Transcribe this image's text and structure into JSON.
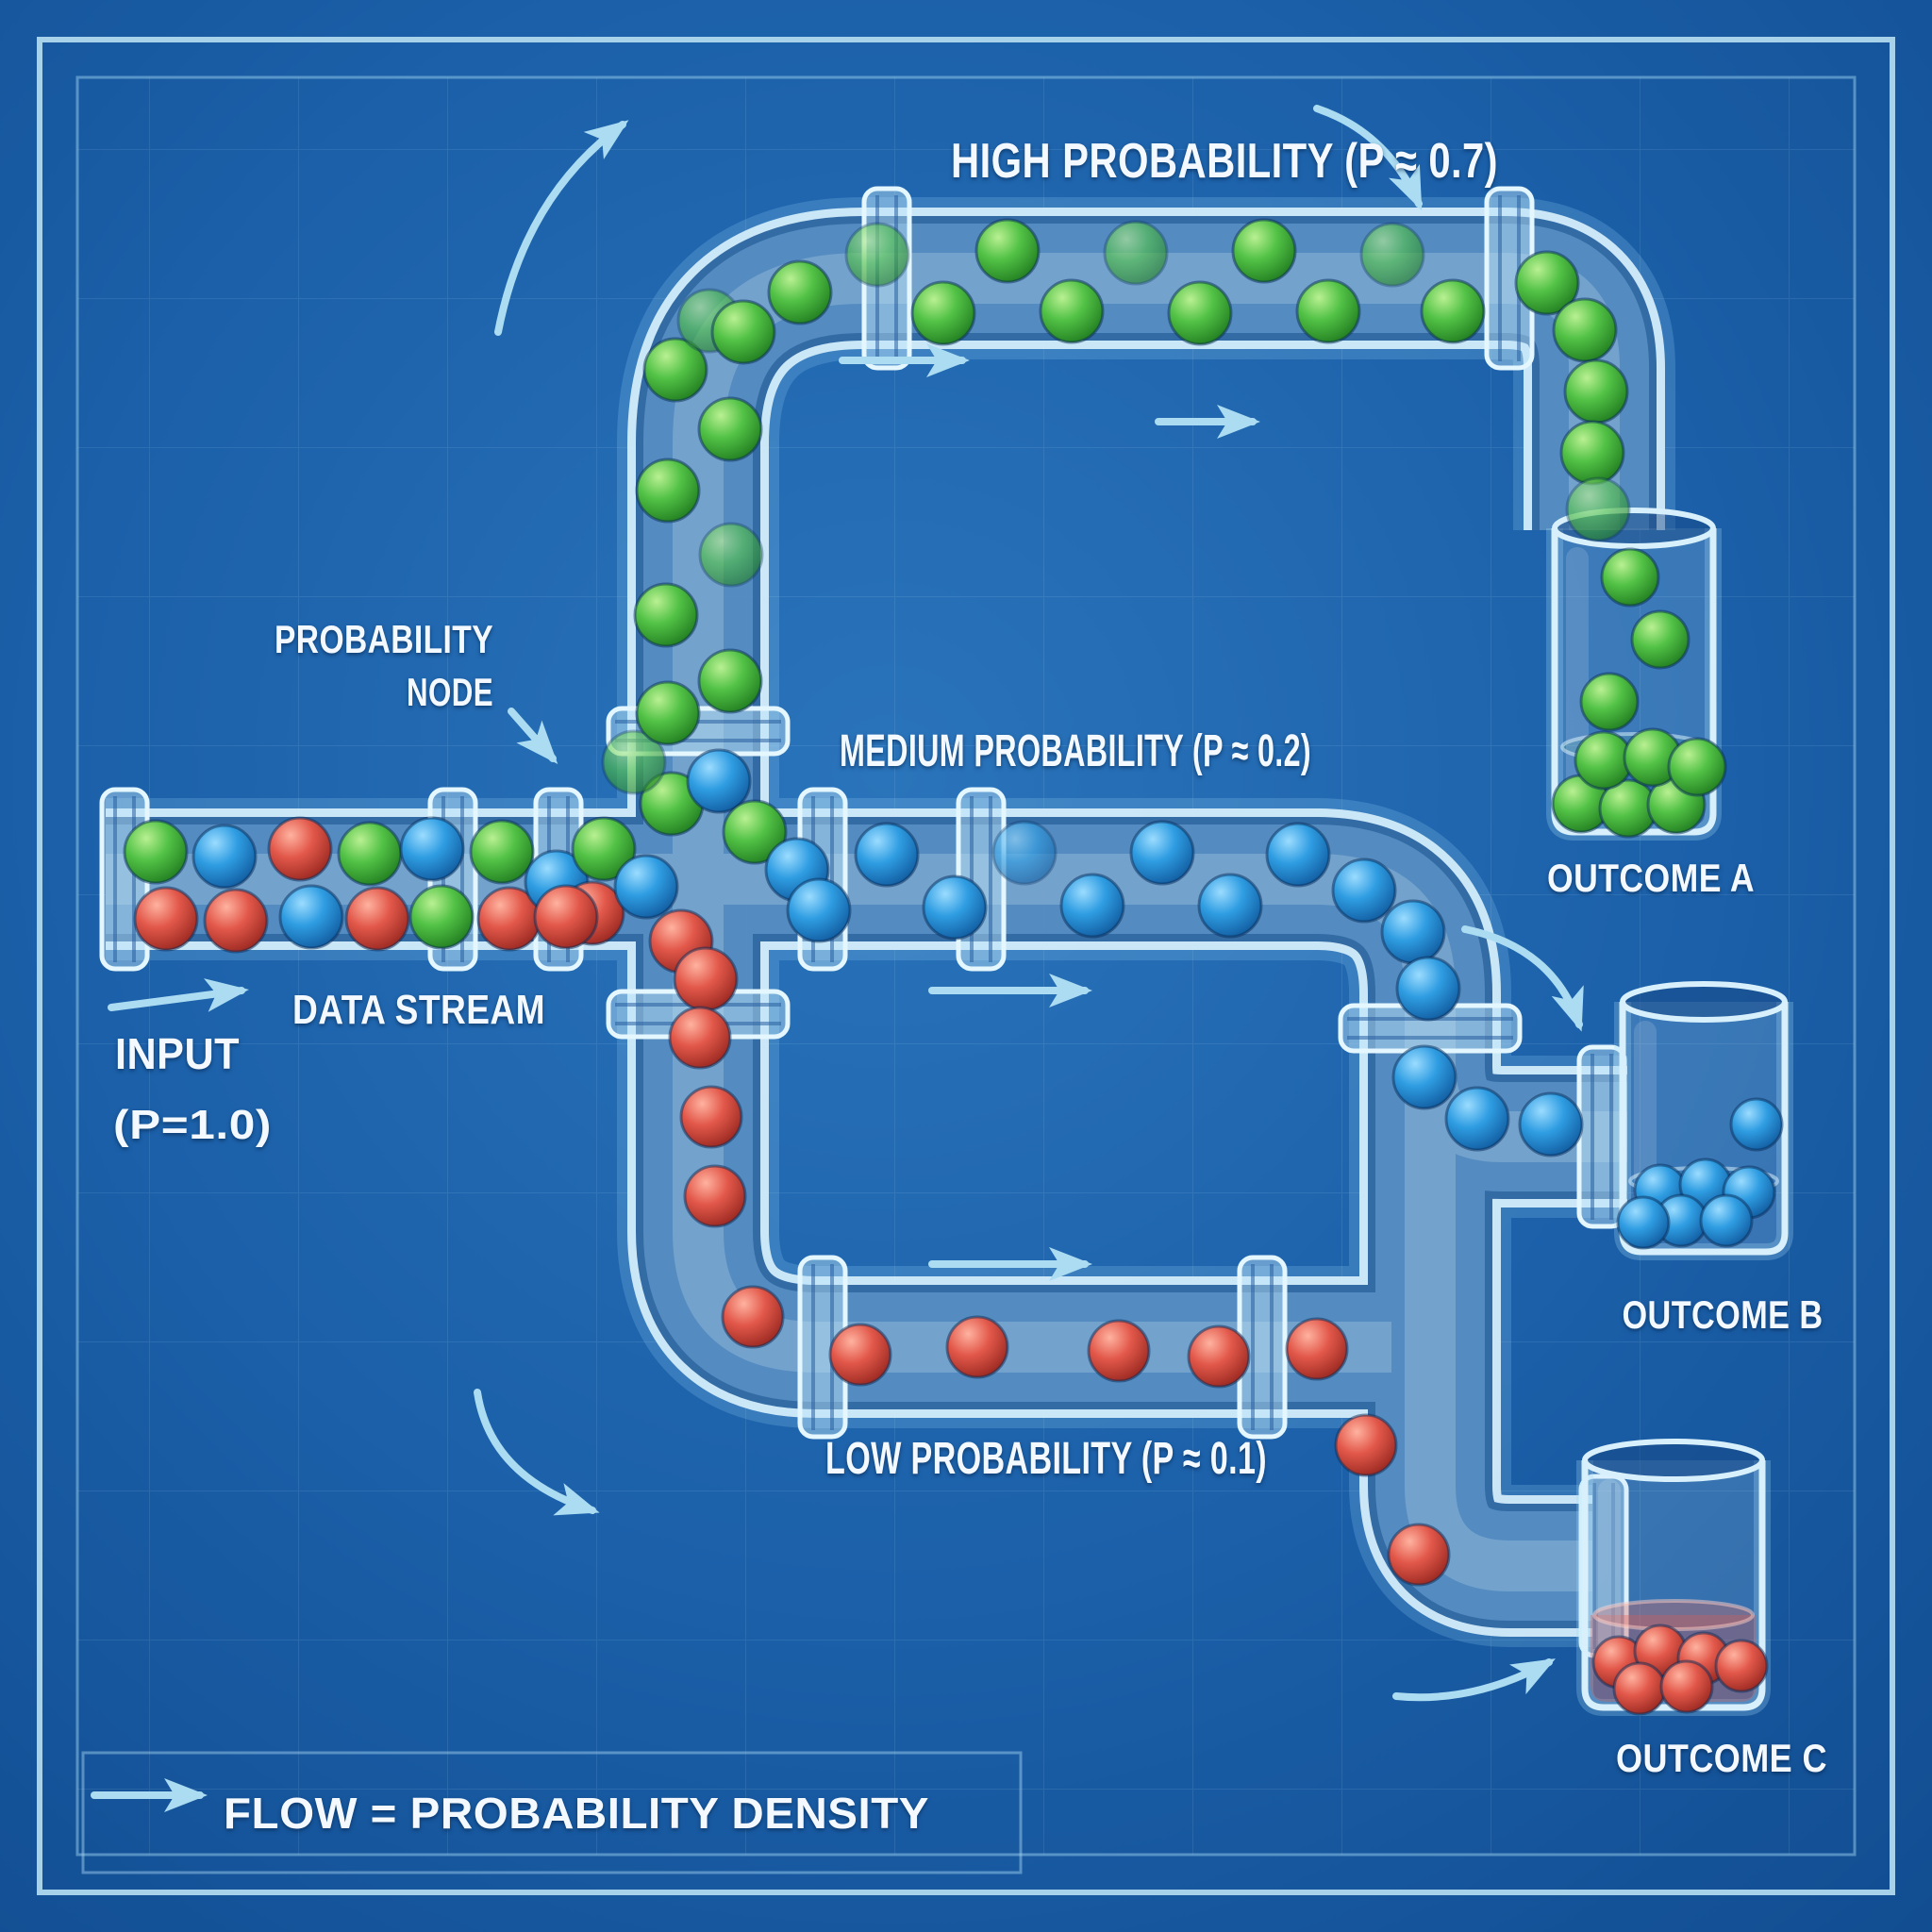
{
  "labels": {
    "high": "HIGH PROBABILITY (P ≈ 0.7)",
    "medium": "MEDIUM PROBABILITY (P ≈ 0.2)",
    "low": "LOW PROBABILITY (P ≈ 0.1)",
    "node1": "PROBABILITY",
    "node2": "NODE",
    "data_stream": "DATA STREAM",
    "input1": "INPUT",
    "input2": "(P=1.0)",
    "outcome_a": "OUTCOME A",
    "outcome_b": "OUTCOME B",
    "outcome_c": "OUTCOME C",
    "legend": "FLOW = PROBABILITY DENSITY"
  },
  "probabilities": {
    "input": "1.0",
    "high": "0.7",
    "medium": "0.2",
    "low": "0.1"
  },
  "colors": {
    "background": "#1b60a9",
    "pipe_outline": "#d7f0fc",
    "arrow": "#abdcf2",
    "ball_green": "#4cb944",
    "ball_blue": "#2f9de2",
    "ball_red": "#df5348",
    "text": "#f3f9ff"
  },
  "balls": {
    "input": [
      [
        165,
        903,
        "g"
      ],
      [
        238,
        908,
        "b"
      ],
      [
        176,
        974,
        "r"
      ],
      [
        250,
        976,
        "r"
      ],
      [
        318,
        900,
        "r"
      ],
      [
        330,
        972,
        "b"
      ],
      [
        392,
        905,
        "g"
      ],
      [
        400,
        974,
        "r"
      ],
      [
        458,
        900,
        "b"
      ],
      [
        468,
        972,
        "g"
      ],
      [
        532,
        903,
        "g"
      ],
      [
        540,
        974,
        "r"
      ],
      [
        590,
        935,
        "b"
      ]
    ],
    "junction": [
      [
        640,
        900,
        "g"
      ],
      [
        628,
        968,
        "r"
      ],
      [
        685,
        940,
        "b"
      ],
      [
        712,
        852,
        "g"
      ],
      [
        762,
        828,
        "b"
      ],
      [
        800,
        882,
        "g"
      ],
      [
        845,
        922,
        "b"
      ],
      [
        868,
        965,
        "b"
      ],
      [
        722,
        998,
        "r"
      ],
      [
        748,
        1038,
        "r"
      ],
      [
        672,
        808,
        "g",
        1
      ],
      [
        600,
        972,
        "r"
      ]
    ],
    "green": [
      [
        708,
        756,
        "g"
      ],
      [
        774,
        722,
        "g"
      ],
      [
        706,
        652,
        "g"
      ],
      [
        775,
        588,
        "g",
        1
      ],
      [
        708,
        520,
        "g"
      ],
      [
        774,
        455,
        "g"
      ],
      [
        716,
        392,
        "g"
      ],
      [
        752,
        340,
        "g",
        1
      ],
      [
        788,
        352,
        "g"
      ],
      [
        848,
        310,
        "g"
      ],
      [
        930,
        270,
        "g",
        1
      ],
      [
        1000,
        332,
        "g"
      ],
      [
        1068,
        266,
        "g"
      ],
      [
        1136,
        330,
        "g"
      ],
      [
        1204,
        268,
        "g",
        1
      ],
      [
        1272,
        332,
        "g"
      ],
      [
        1340,
        266,
        "g"
      ],
      [
        1408,
        330,
        "g"
      ],
      [
        1476,
        270,
        "g",
        1
      ],
      [
        1540,
        330,
        "g"
      ],
      [
        1640,
        300,
        "g"
      ],
      [
        1680,
        350,
        "g"
      ],
      [
        1692,
        415,
        "g"
      ],
      [
        1688,
        480,
        "g"
      ],
      [
        1694,
        540,
        "g",
        1
      ]
    ],
    "blue": [
      [
        940,
        906,
        "b"
      ],
      [
        1012,
        962,
        "b"
      ],
      [
        1086,
        904,
        "b",
        1
      ],
      [
        1158,
        960,
        "b"
      ],
      [
        1232,
        904,
        "b"
      ],
      [
        1304,
        960,
        "b"
      ],
      [
        1376,
        906,
        "b"
      ],
      [
        1446,
        944,
        "b"
      ],
      [
        1498,
        988,
        "b"
      ],
      [
        1514,
        1048,
        "b"
      ],
      [
        1510,
        1142,
        "b"
      ],
      [
        1566,
        1186,
        "b"
      ],
      [
        1644,
        1192,
        "b"
      ]
    ],
    "red": [
      [
        742,
        1100,
        "r"
      ],
      [
        754,
        1184,
        "r"
      ],
      [
        758,
        1268,
        "r"
      ],
      [
        798,
        1396,
        "r"
      ],
      [
        912,
        1436,
        "r"
      ],
      [
        1036,
        1428,
        "r"
      ],
      [
        1186,
        1432,
        "r"
      ],
      [
        1292,
        1438,
        "r"
      ],
      [
        1396,
        1430,
        "r"
      ],
      [
        1448,
        1532,
        "r"
      ],
      [
        1504,
        1648,
        "r"
      ]
    ],
    "outcome_a": [
      [
        1728,
        612,
        "g"
      ],
      [
        1760,
        678,
        "g"
      ],
      [
        1706,
        744,
        "g"
      ],
      [
        1676,
        852,
        "g"
      ],
      [
        1726,
        857,
        "g"
      ],
      [
        1777,
        853,
        "g"
      ],
      [
        1700,
        806,
        "g"
      ],
      [
        1752,
        803,
        "g"
      ],
      [
        1799,
        813,
        "g"
      ]
    ],
    "outcome_b": [
      [
        1862,
        1192,
        "b"
      ],
      [
        1760,
        1262,
        "b"
      ],
      [
        1808,
        1256,
        "b"
      ],
      [
        1854,
        1264,
        "b"
      ],
      [
        1782,
        1294,
        "b"
      ],
      [
        1830,
        1294,
        "b"
      ],
      [
        1742,
        1296,
        "b"
      ]
    ],
    "outcome_c": [
      [
        1716,
        1762,
        "r"
      ],
      [
        1760,
        1750,
        "r"
      ],
      [
        1806,
        1758,
        "r"
      ],
      [
        1846,
        1766,
        "r"
      ],
      [
        1738,
        1790,
        "r"
      ],
      [
        1788,
        1788,
        "r"
      ]
    ]
  }
}
